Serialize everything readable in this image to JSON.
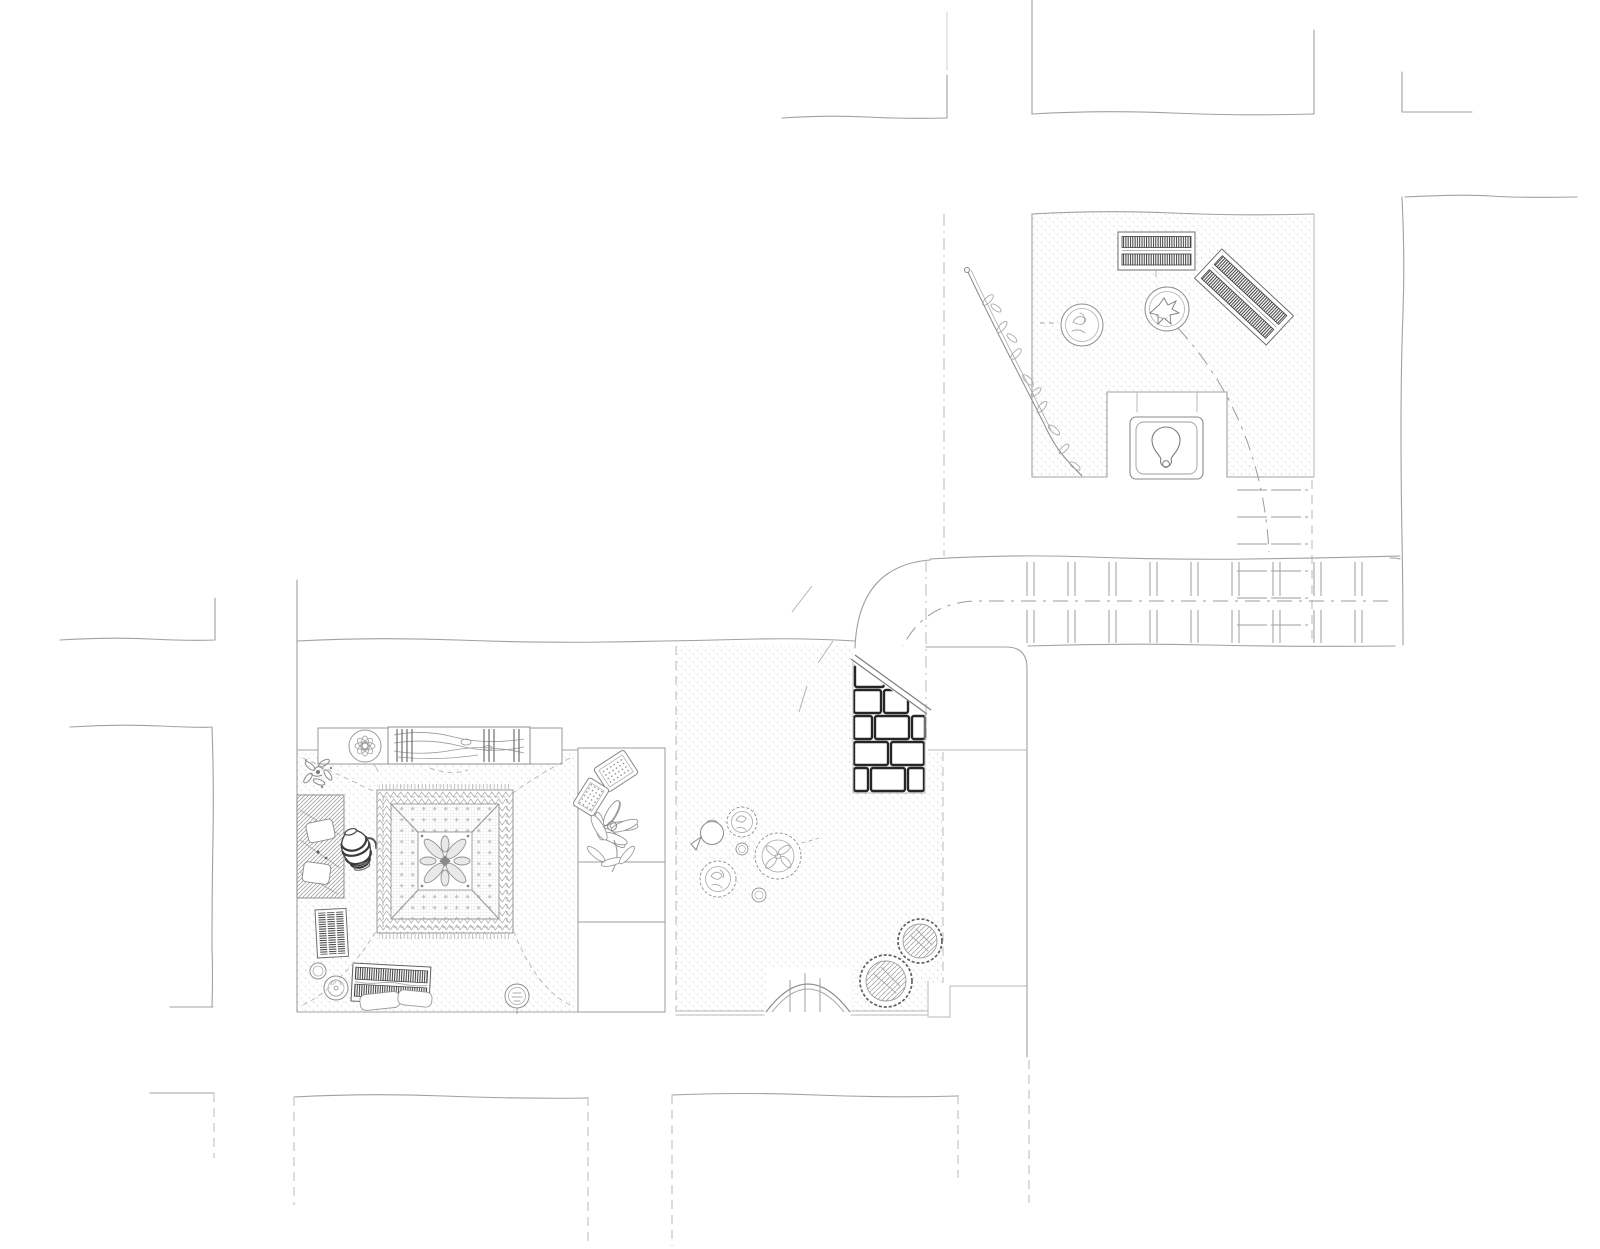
{
  "document": {
    "title": "Hand-drawn architectural floor plan sketch",
    "type": "floor-plan",
    "style": "pencil sketch, monochrome, stippled floor texture",
    "visible_text": []
  },
  "palette": {
    "paper": "#ffffff",
    "wall": "#a0a0a0",
    "faint": "#b9b9b9",
    "furn": "#8a8a8a",
    "dark": "#2a2a2a",
    "stipple": "#c6c6c6",
    "carpet": "#a9a9a9"
  },
  "plan": {
    "rooms": [
      {
        "name": "upper-terrace-room",
        "floor": "stippled",
        "elements": [
          "striped-mat-horizontal",
          "striped-mat-rotated",
          "planter-pot-1",
          "planter-pot-2",
          "climbing-branch-plant",
          "toilet-alcove",
          "squat-toilet"
        ]
      },
      {
        "name": "stair-corridor",
        "floor": "plain",
        "elements": [
          "stair-treads",
          "curved-outer-wall",
          "dashed-walk-line"
        ]
      },
      {
        "name": "brick-staircase",
        "elements": [
          "brick-masonry-section",
          "handrail-diagonal"
        ]
      },
      {
        "name": "carpet-room",
        "floor": "stippled",
        "elements": [
          "ornate-square-carpet",
          "wood-log-bench",
          "rosette-stool",
          "corner-plant",
          "textured-bed",
          "striped-jug",
          "striped-mat-small",
          "striped-bench",
          "cushions",
          "small-stools"
        ]
      },
      {
        "name": "storage-niche",
        "elements": [
          "dotted-pillow-1",
          "dotted-pillow-2",
          "large-flower-plant",
          "empty-shelf-1",
          "empty-shelf-2"
        ]
      },
      {
        "name": "courtyard",
        "floor": "stippled",
        "elements": [
          "plant-cluster",
          "kettle-pot",
          "round-tub-1",
          "round-tub-2",
          "arched-doorway"
        ]
      }
    ],
    "walls": [
      "top-wall-fragments",
      "right-wall",
      "long-party-wall",
      "left-street-walls",
      "bottom-wall-blocks"
    ]
  }
}
